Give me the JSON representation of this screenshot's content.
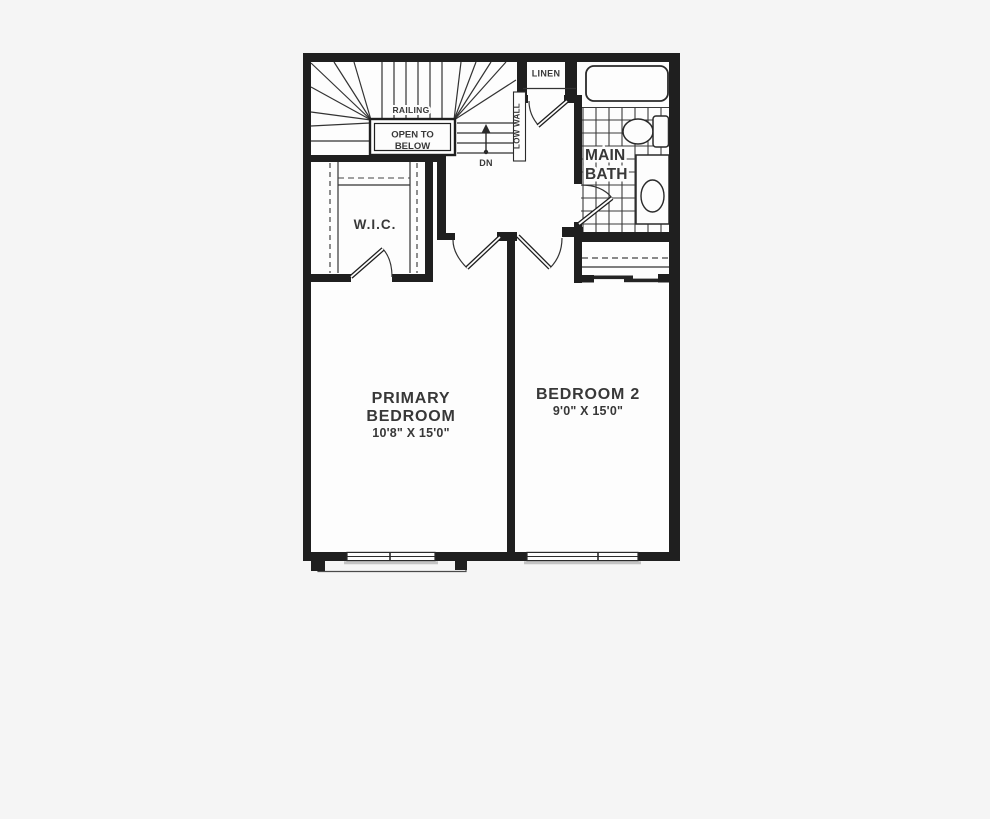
{
  "floor_plan": {
    "rooms": {
      "primary_bedroom": {
        "name_line1": "PRIMARY",
        "name_line2": "BEDROOM",
        "dimensions": "10'8\" X 15'0\""
      },
      "bedroom_2": {
        "name": "BEDROOM 2",
        "dimensions": "9'0\" X 15'0\""
      },
      "walk_in_closet": {
        "name": "W.I.C."
      },
      "main_bath": {
        "name_line1": "MAIN",
        "name_line2": "BATH"
      },
      "linen_closet": {
        "name": "LINEN"
      }
    },
    "stairs": {
      "railing_label": "RAILING",
      "open_to_below_line1": "OPEN TO",
      "open_to_below_line2": "BELOW",
      "low_wall_label": "LOW WALL",
      "down_label": "DN"
    },
    "colors": {
      "background": "#f5f5f5",
      "floor": "#fdfdfd",
      "wall": "#1f1f1f",
      "line": "#333333",
      "window_sill": "#c3c3c3",
      "text": "#383838"
    }
  }
}
